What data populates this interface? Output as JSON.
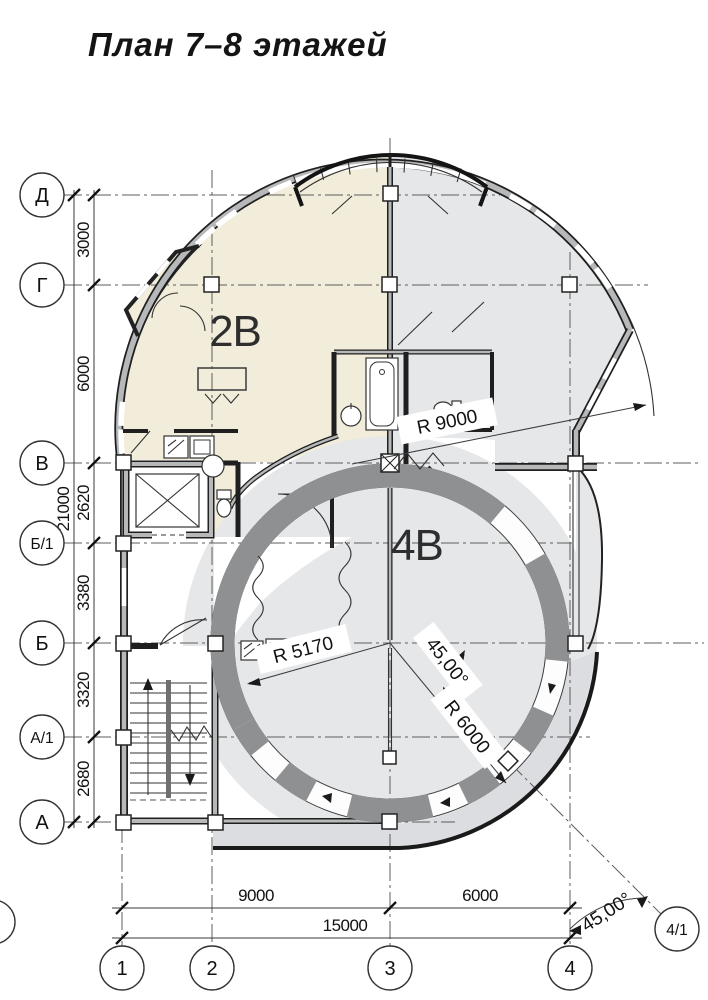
{
  "title": "План 7–8 этажей",
  "rooms": {
    "apartment_left": "2В",
    "apartment_right": "4В"
  },
  "axes": {
    "left": [
      "Д",
      "Г",
      "В",
      "Б/1",
      "Б",
      "А/1",
      "А"
    ],
    "bottom": [
      "1",
      "2",
      "3",
      "4"
    ],
    "diagonal": "4/1",
    "edge_partial": "1"
  },
  "dimensions": {
    "left_segments": [
      "3000",
      "6000",
      "2620",
      "3380",
      "3320",
      "2680"
    ],
    "left_total": "21000",
    "bottom_segments": [
      "9000",
      "6000"
    ],
    "bottom_total": "15000",
    "bottom_angle": "45,00°",
    "inner_angle": "45,00°",
    "radius_building": "R 9000",
    "radius_room": "R 5170",
    "radius_ring": "R 6000"
  },
  "colors": {
    "apartment_cream": "#f1edda",
    "apartment_gray": "#e6e7e9",
    "balcony_gray": "#dcdde0",
    "wall_gray": "#b7b8ba",
    "pier_gray": "#8e9092",
    "line_dark": "#1f1f1f"
  }
}
